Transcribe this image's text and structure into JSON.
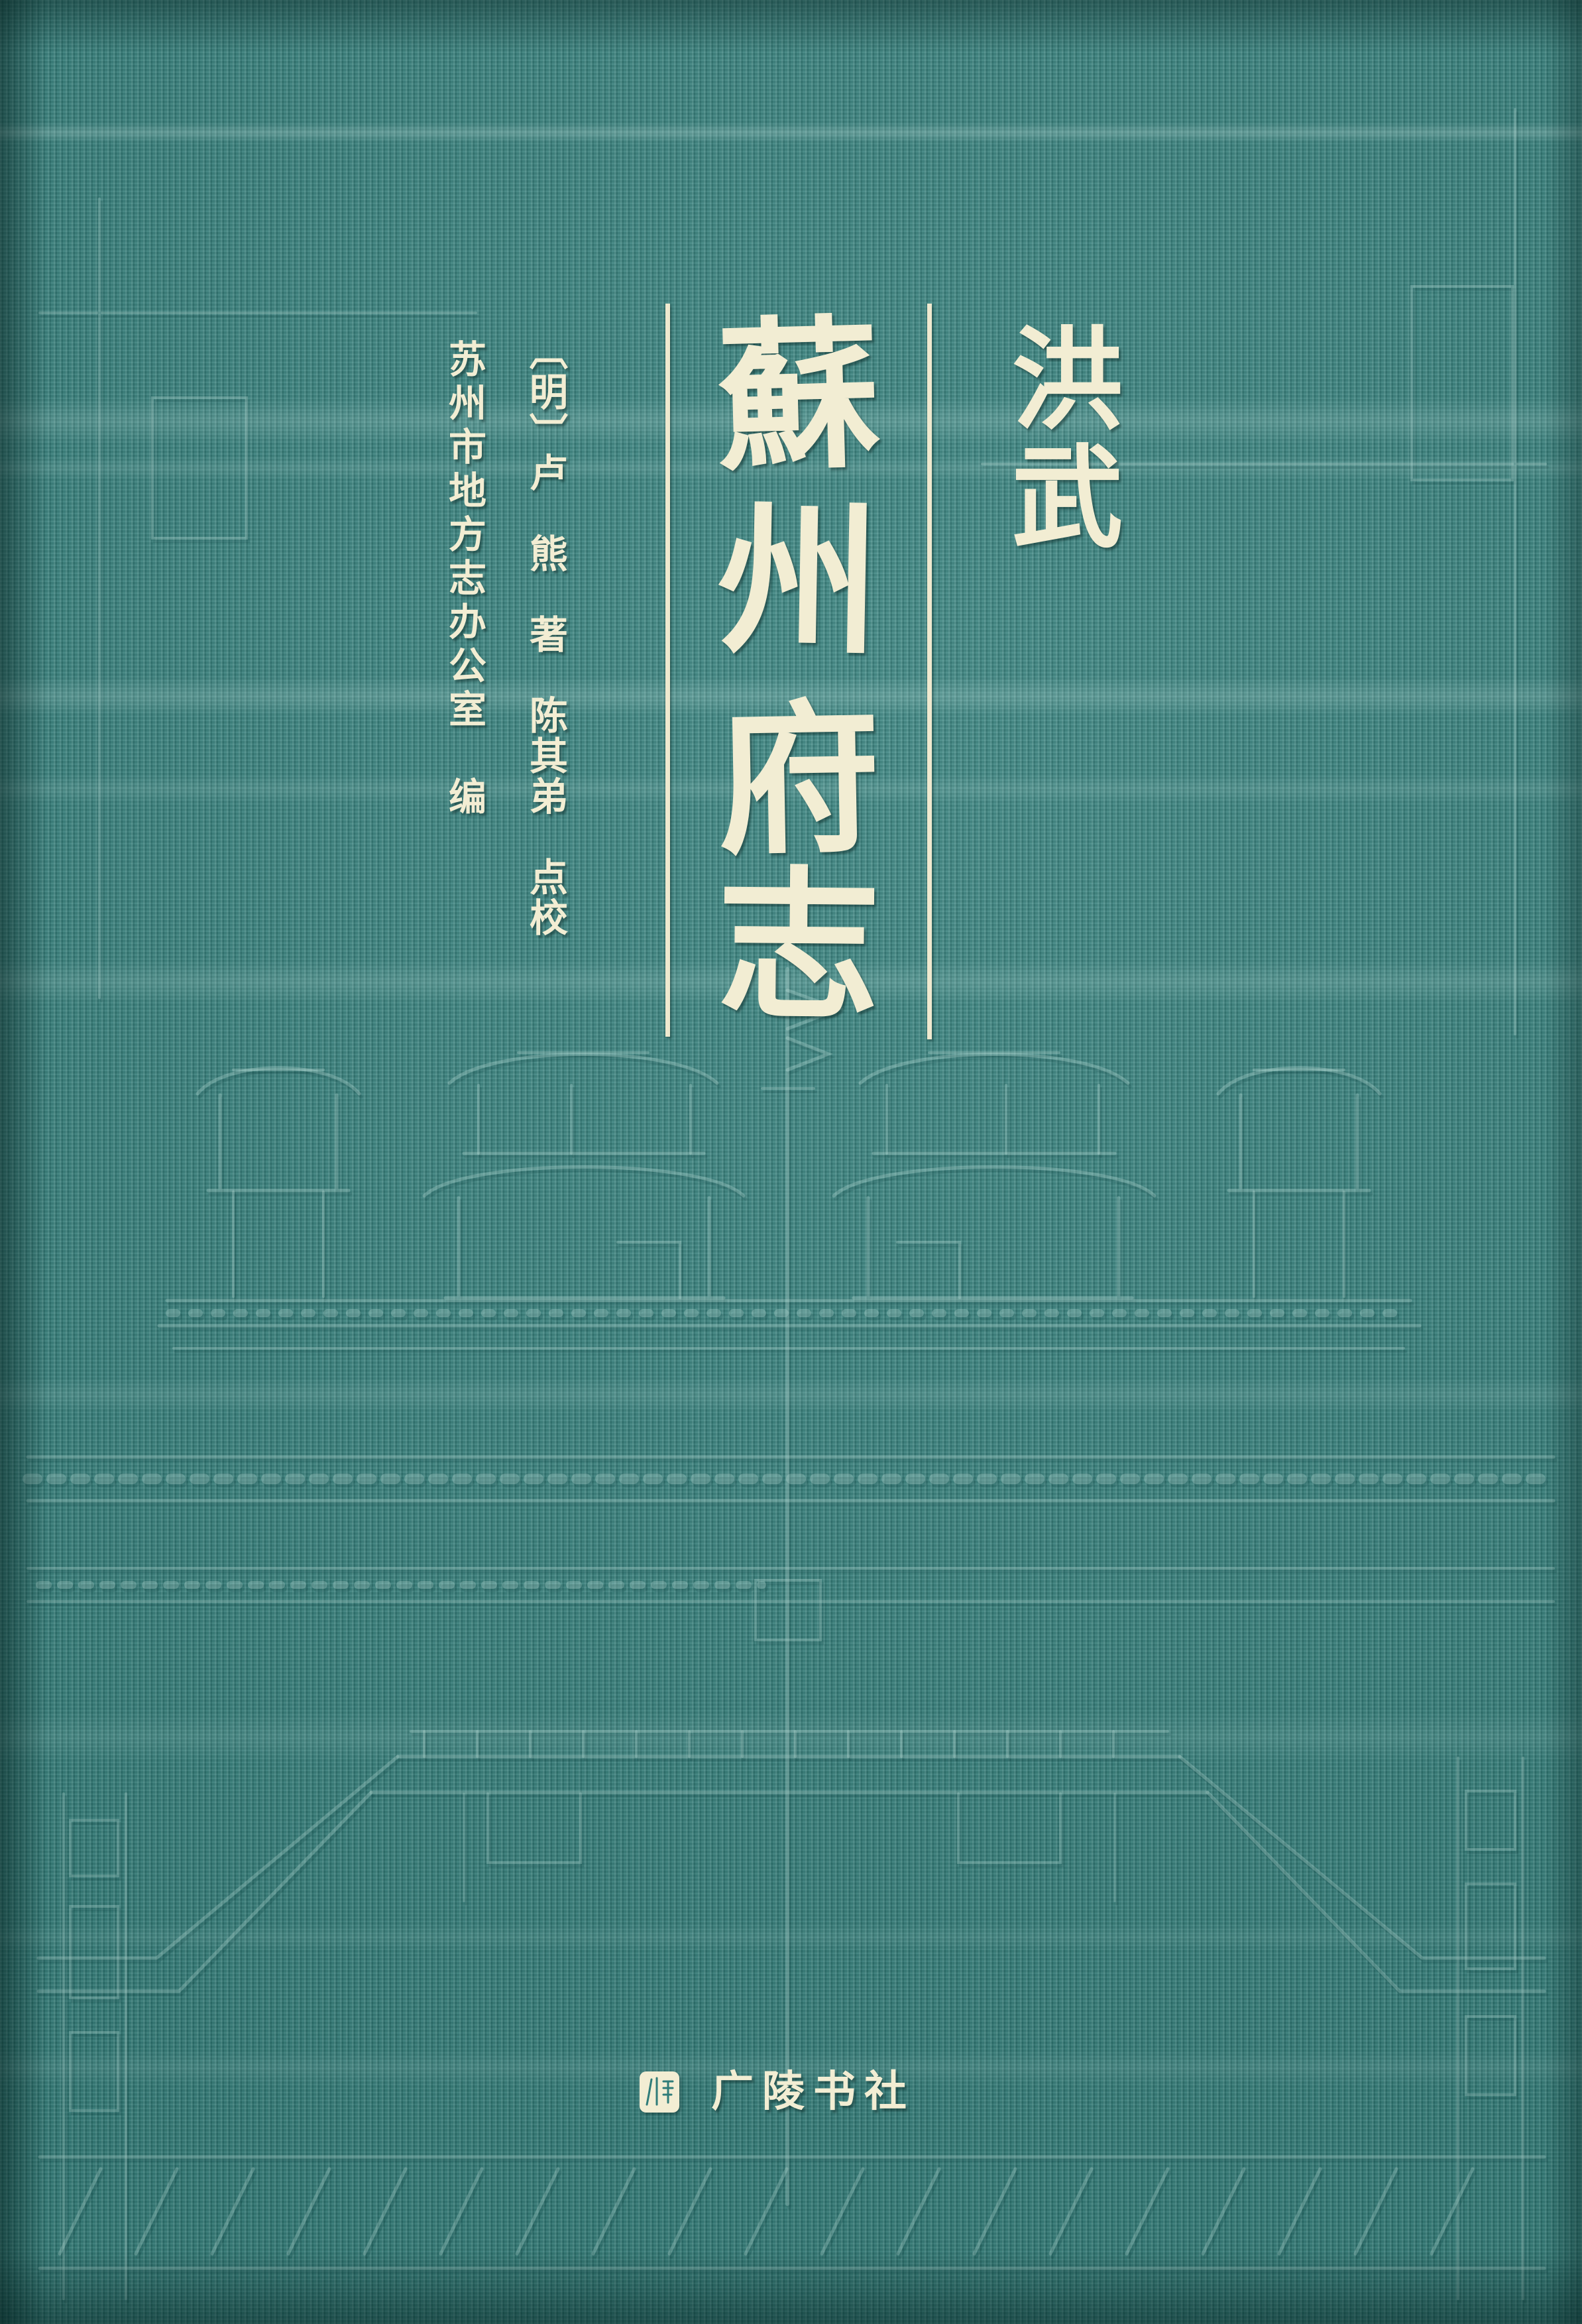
{
  "book_cover": {
    "era_label": "洪武",
    "title": "蘇州府志",
    "title_chars": [
      "蘇",
      "州",
      "府",
      "志"
    ],
    "byline": "〔明〕卢　熊　著　陈其弟　点校",
    "editor_line": "苏州市地方志办公室　编",
    "publisher_name": "广陵书社",
    "colors": {
      "fabric_teal": "#35807c",
      "lettering_cream": "#f2edd3",
      "emboss_highlight": "#bfe4de",
      "emboss_shadow": "#0d4442"
    }
  }
}
